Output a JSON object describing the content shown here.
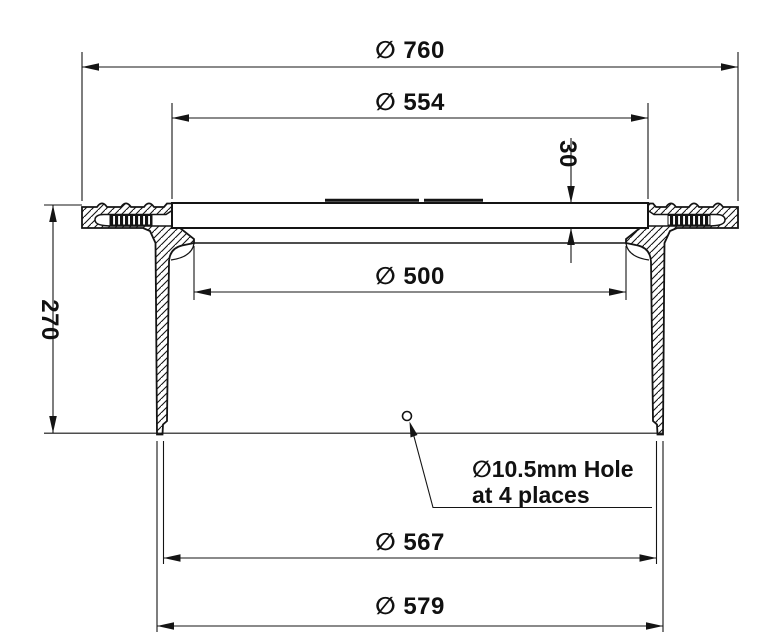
{
  "drawing": {
    "kind": "manhole-frame-and-cover-cross-section",
    "background": "#ffffff",
    "line_color": "#141414",
    "dims": {
      "d760": {
        "label": "∅ 760"
      },
      "d554": {
        "label": "∅ 554"
      },
      "d30": {
        "label": "30"
      },
      "d500": {
        "label": "∅ 500"
      },
      "d270": {
        "label": "270"
      },
      "d567": {
        "label": "∅ 567"
      },
      "d579": {
        "label": "∅ 579"
      }
    },
    "hole_note": {
      "line1": "∅10.5mm Hole",
      "line2": "at 4 places"
    }
  }
}
